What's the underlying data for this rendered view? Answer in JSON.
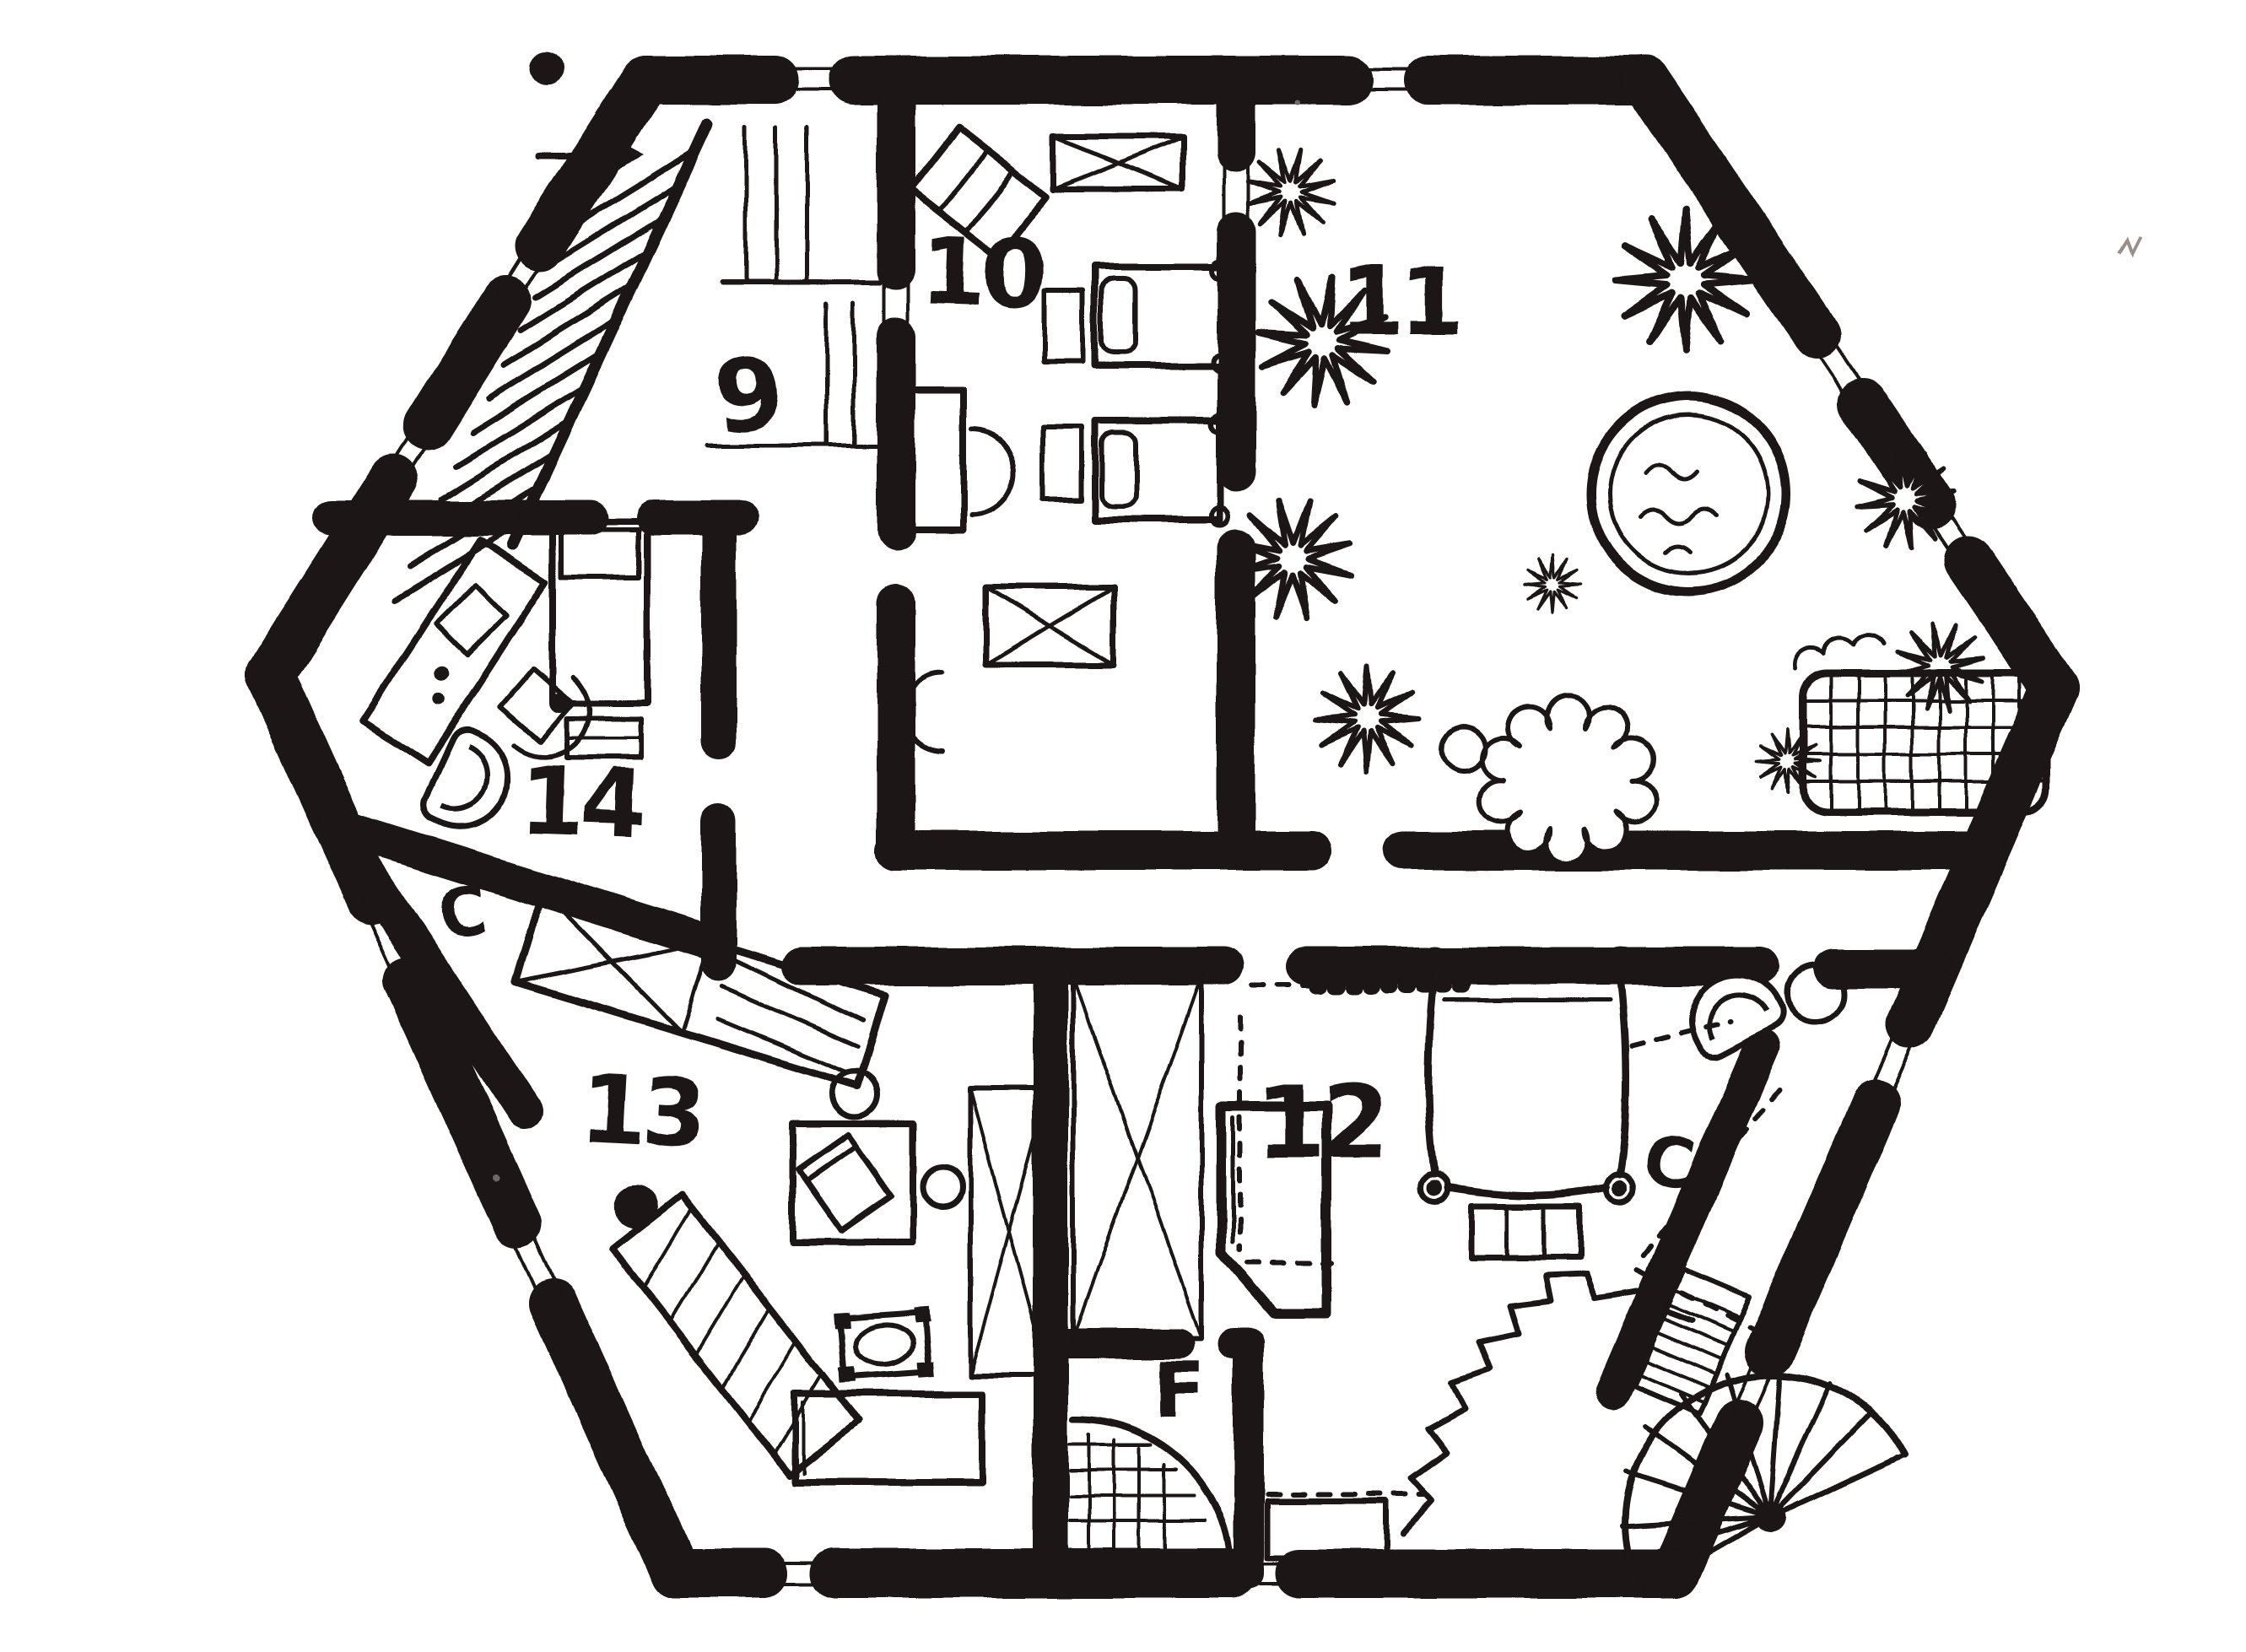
{
  "page": {
    "title": "Hand-drawn hexagonal floor plan",
    "paper_color": "#ffffff",
    "ink_color": "#1a1613"
  },
  "labels": {
    "room9": "9",
    "room10": "10",
    "room11": "11",
    "room12": "12",
    "room13": "13",
    "room14": "14",
    "closet_14": "C",
    "closet_12": "C",
    "bath": "F"
  },
  "rooms": [
    {
      "label": "9"
    },
    {
      "label": "10"
    },
    {
      "label": "11"
    },
    {
      "label": "12"
    },
    {
      "label": "13"
    },
    {
      "label": "14"
    },
    {
      "label": "C"
    },
    {
      "label": "C"
    },
    {
      "label": "F"
    }
  ]
}
